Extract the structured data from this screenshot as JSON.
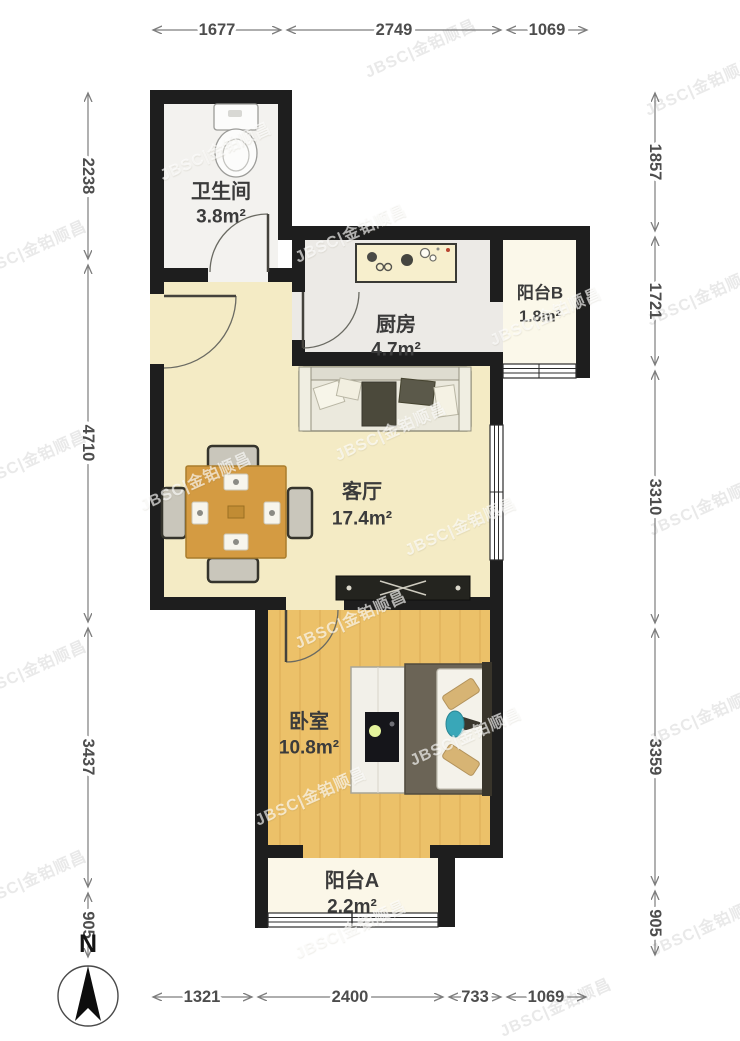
{
  "watermark": {
    "text": "JBSC|金铂顺昌"
  },
  "compass": {
    "label": "N"
  },
  "rooms": {
    "bathroom": {
      "name": "卫生间",
      "area": "3.8m²"
    },
    "kitchen": {
      "name": "厨房",
      "area": "4.7m²"
    },
    "balcony_b": {
      "name": "阳台B",
      "area": "1.8m²"
    },
    "living": {
      "name": "客厅",
      "area": "17.4m²"
    },
    "bedroom": {
      "name": "卧室",
      "area": "10.8m²"
    },
    "balcony_a": {
      "name": "阳台A",
      "area": "2.2m²"
    }
  },
  "dimensions": {
    "top": [
      "1677",
      "2749",
      "1069"
    ],
    "left": [
      "2238",
      "4710",
      "3437",
      "905"
    ],
    "right": [
      "1857",
      "1721",
      "3310",
      "3359",
      "905"
    ],
    "bottom": [
      "1321",
      "2400",
      "733",
      "1069"
    ]
  },
  "colors": {
    "wall": "#1e1e1e",
    "living_floor": "#f4ebc5",
    "bedroom_floor": "#ecc169",
    "table_wood": "#d49b42"
  }
}
